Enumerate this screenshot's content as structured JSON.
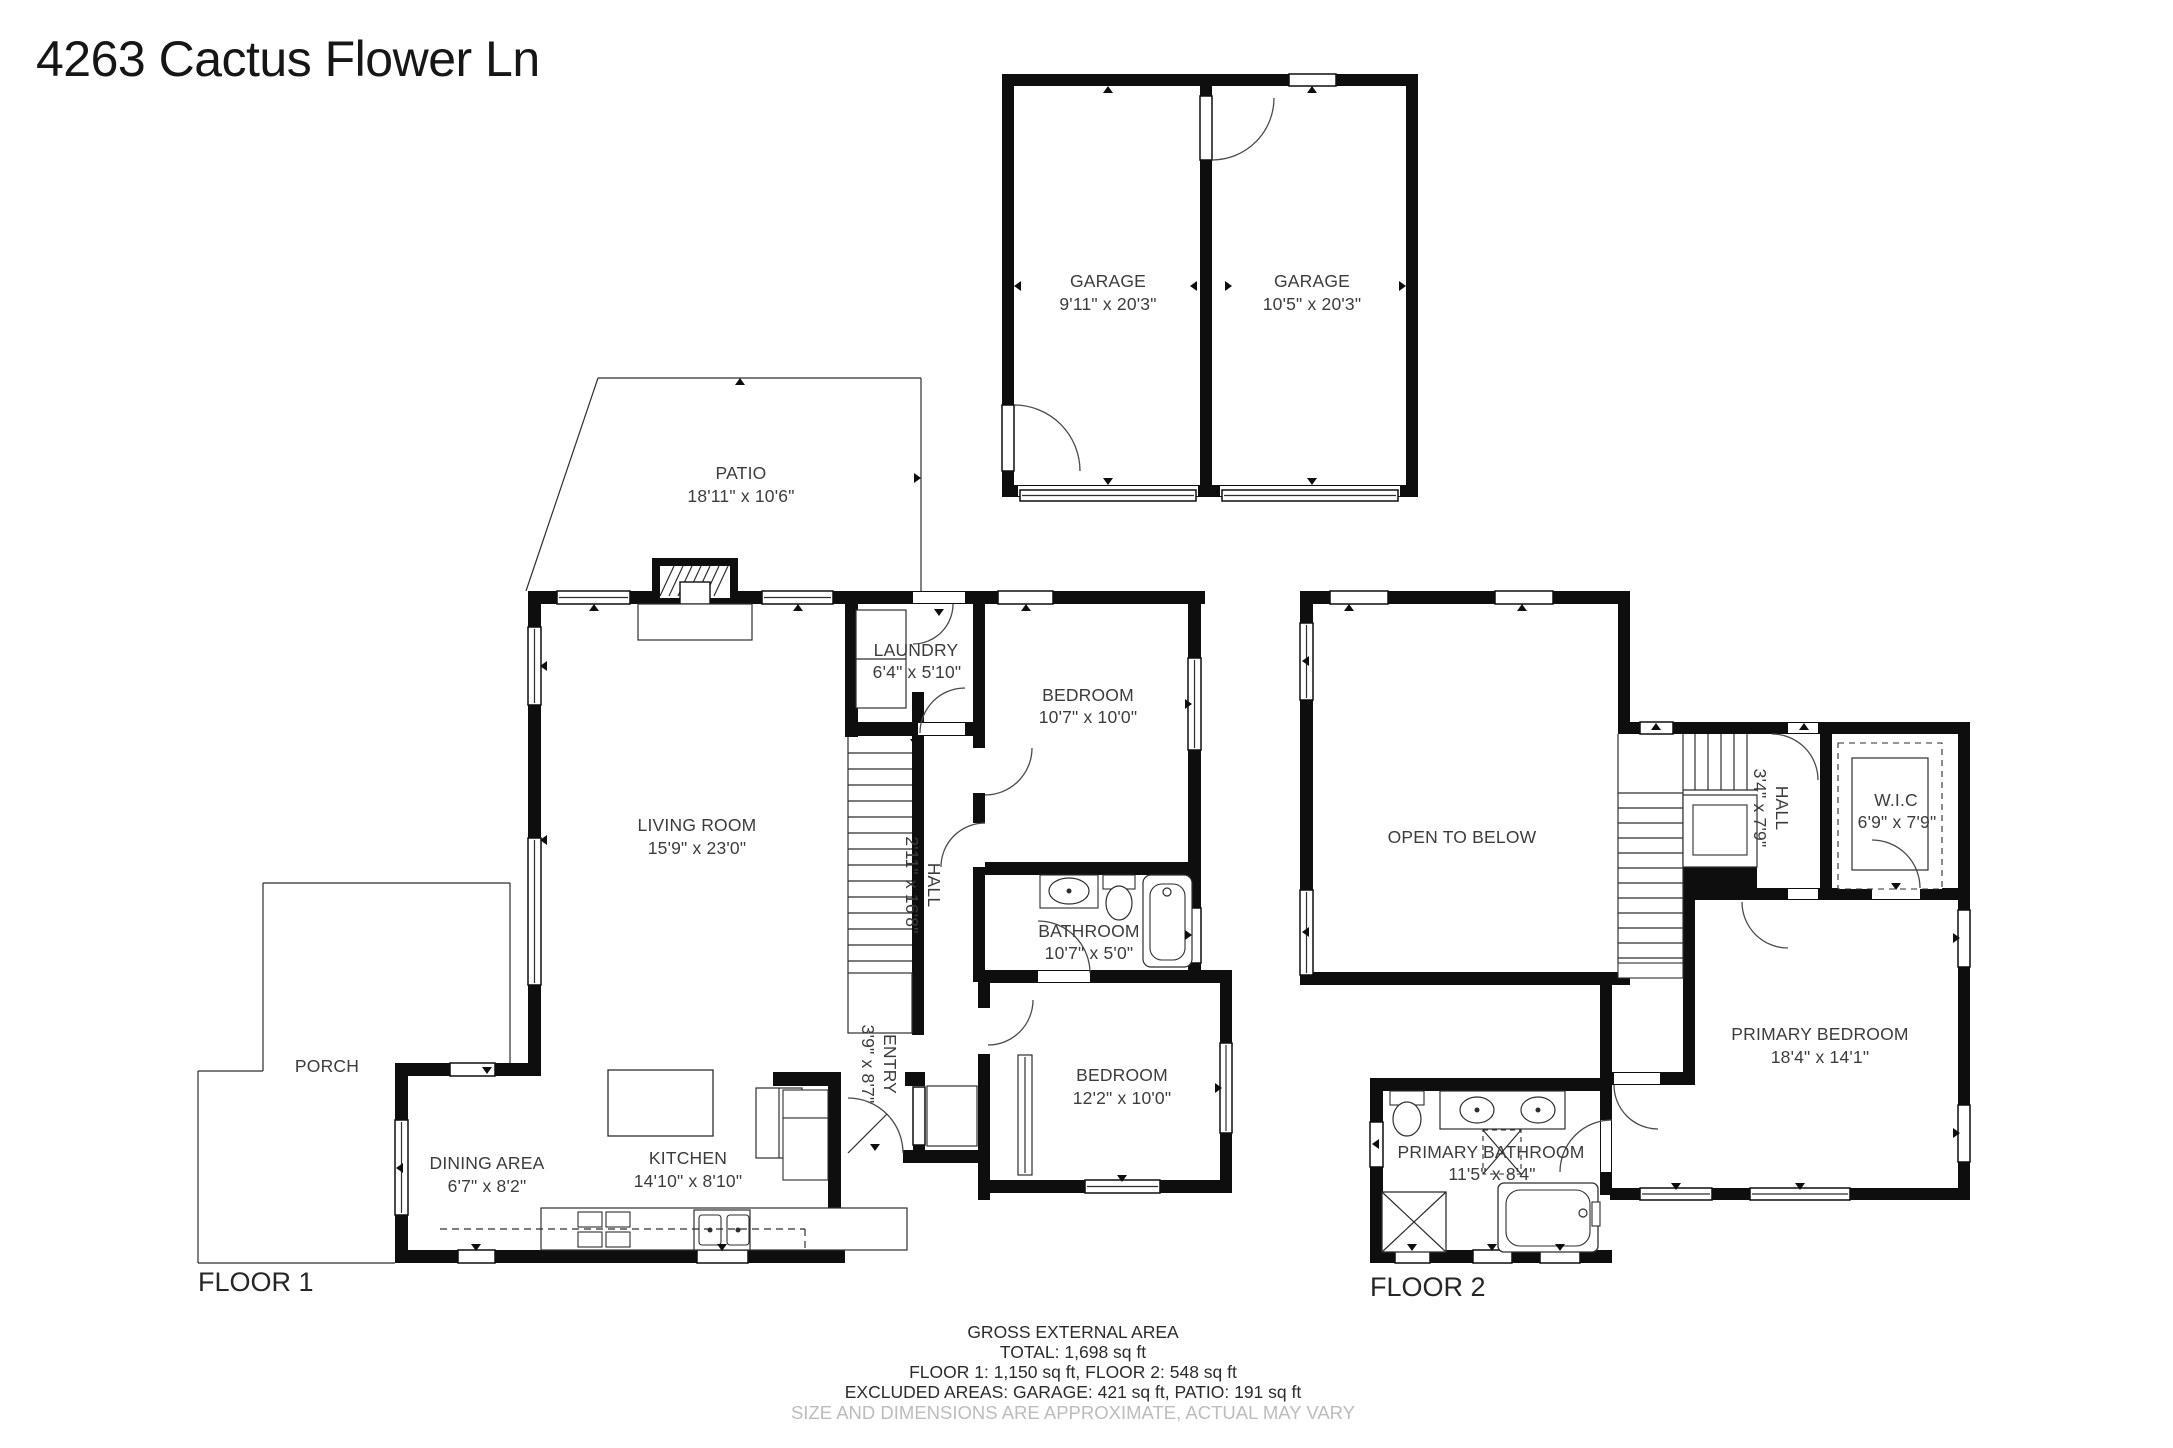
{
  "title": "4263 Cactus Flower Ln",
  "garage": {
    "left": {
      "name": "GARAGE",
      "dims": "9'11\" x 20'3\""
    },
    "right": {
      "name": "GARAGE",
      "dims": "10'5\" x 20'3\""
    }
  },
  "floor1": {
    "label": "FLOOR 1",
    "rooms": {
      "patio": {
        "name": "PATIO",
        "dims": "18'11\" x 10'6\""
      },
      "living_room": {
        "name": "LIVING ROOM",
        "dims": "15'9\" x 23'0\""
      },
      "laundry": {
        "name": "LAUNDRY",
        "dims": "6'4\" x 5'10\""
      },
      "bedroom_top": {
        "name": "BEDROOM",
        "dims": "10'7\" x 10'0\""
      },
      "hall": {
        "name": "HALL",
        "dims": "2'11\" x 16'8\""
      },
      "bathroom": {
        "name": "BATHROOM",
        "dims": "10'7\" x 5'0\""
      },
      "bedroom_bottom": {
        "name": "BEDROOM",
        "dims": "12'2\" x 10'0\""
      },
      "entry": {
        "name": "ENTRY",
        "dims": "3'9\" x 8'7\""
      },
      "porch": {
        "name": "PORCH"
      },
      "dining_area": {
        "name": "DINING AREA",
        "dims": "6'7\" x 8'2\""
      },
      "kitchen": {
        "name": "KITCHEN",
        "dims": "14'10\" x 8'10\""
      }
    }
  },
  "floor2": {
    "label": "FLOOR 2",
    "rooms": {
      "open_to_below": {
        "name": "OPEN TO BELOW"
      },
      "hall": {
        "name": "HALL",
        "dims": "3'4\" x 7'9\""
      },
      "wic": {
        "name": "W.I.C",
        "dims": "6'9\" x 7'9\""
      },
      "primary_bedroom": {
        "name": "PRIMARY BEDROOM",
        "dims": "18'4\" x 14'1\""
      },
      "primary_bathroom": {
        "name": "PRIMARY BATHROOM",
        "dims": "11'5\" x 8'4\""
      }
    }
  },
  "footer": {
    "line1": "GROSS EXTERNAL AREA",
    "line2": "TOTAL: 1,698 sq ft",
    "line3": "FLOOR 1: 1,150 sq ft, FLOOR 2: 548 sq ft",
    "line4": "EXCLUDED AREAS: GARAGE: 421 sq ft, PATIO: 191 sq ft",
    "disclaimer": "SIZE AND DIMENSIONS ARE APPROXIMATE, ACTUAL MAY VARY"
  },
  "colors": {
    "wall": "#0e0e0e",
    "label": "#3c3c3c",
    "disclaimer": "#bcbcbc"
  }
}
